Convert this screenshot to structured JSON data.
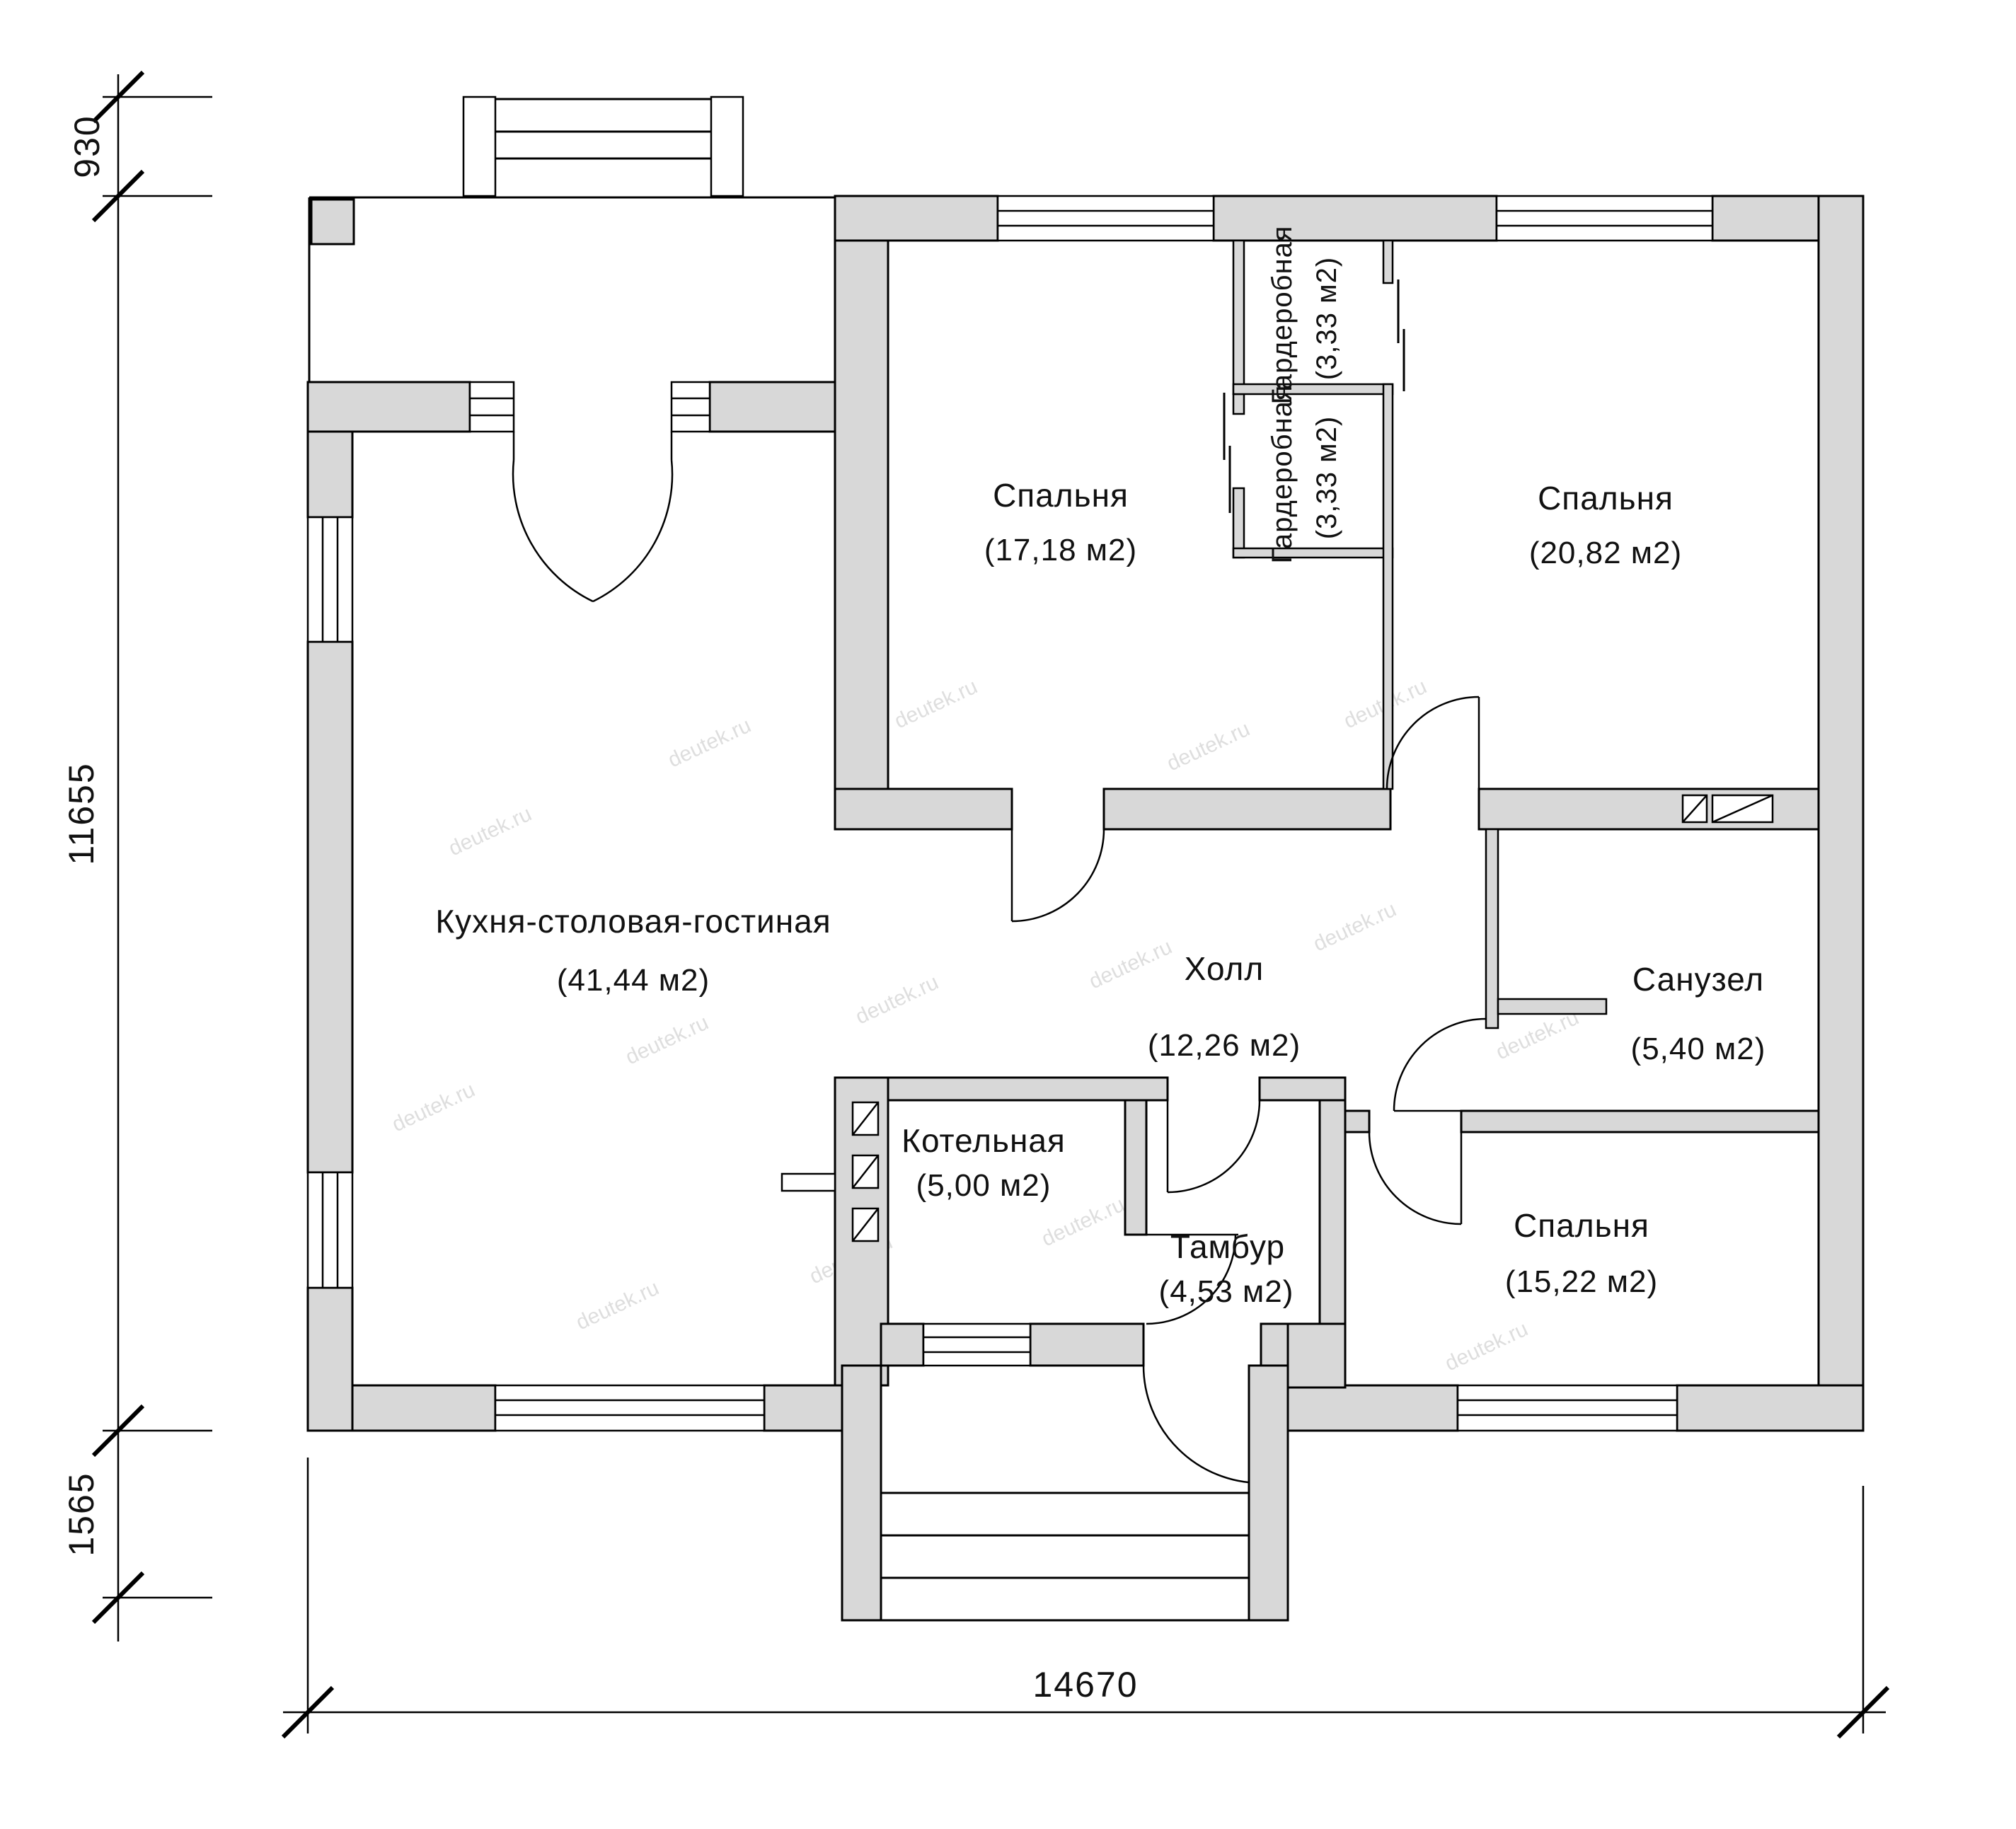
{
  "rooms": {
    "kitchen": {
      "name": "Кухня-столовая-гостиная",
      "area": "(41,44 м2)"
    },
    "bedroom1": {
      "name": "Спальня",
      "area": "(17,18 м2)"
    },
    "wardrobe1": {
      "name": "Гардеробная",
      "area": "(3,33 м2)"
    },
    "wardrobe2": {
      "name": "Гардеробная",
      "area": "(3,33 м2)"
    },
    "bedroom2": {
      "name": "Спальня",
      "area": "(20,82 м2)"
    },
    "hall": {
      "name": "Холл",
      "area": "(12,26 м2)"
    },
    "bathroom": {
      "name": "Санузел",
      "area": "(5,40 м2)"
    },
    "boiler": {
      "name": "Котельная",
      "area": "(5,00 м2)"
    },
    "vestibule": {
      "name": "Тамбур",
      "area": "(4,53 м2)"
    },
    "bedroom3": {
      "name": "Спальня",
      "area": "(15,22 м2)"
    }
  },
  "dimensions": {
    "top_left": "930",
    "left": "11655",
    "bottom_left": "1565",
    "bottom": "14670"
  },
  "watermark": {
    "text": "deutek.ru"
  },
  "colors": {
    "wall_fill": "#d8d8d8",
    "line": "#000000",
    "watermark": "#c9c9c9"
  }
}
